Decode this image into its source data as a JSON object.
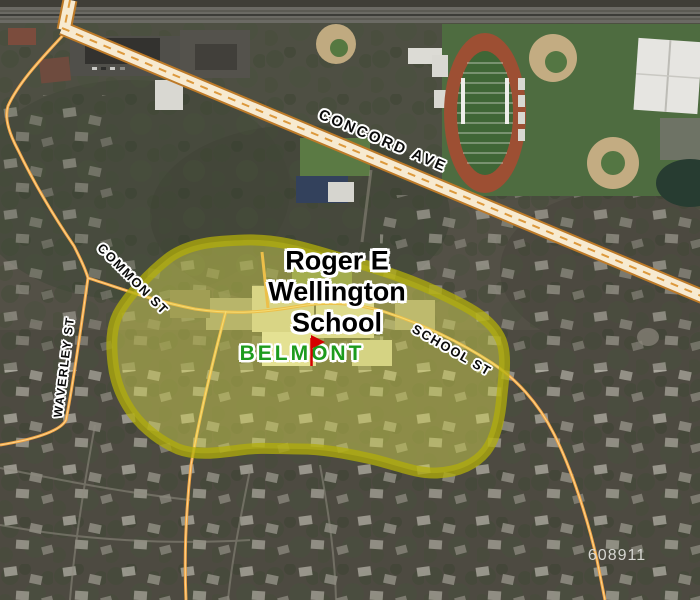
{
  "map": {
    "streets": {
      "concord": "CONCORD AVE",
      "common": "COMMON ST",
      "waverley": "WAVERLEY ST",
      "school": "SCHOOL ST"
    },
    "school_label": {
      "line1": "Roger E",
      "line2": "Wellington",
      "line3": "School"
    },
    "town_label": "BELMONT",
    "map_number": "608911",
    "zone": {
      "fill": "#e8e654",
      "fill_opacity": "0.42",
      "border": "#b2ad0a"
    },
    "marker": {
      "color": "#d40000"
    },
    "road_colors": {
      "major_fill": "#f7ead0",
      "major_casing": "#bd7a28",
      "major_dash": "#dd993c",
      "minor": "#f0a243",
      "minor_core": "#ffd891"
    },
    "label_colors": {
      "street": "#0a0a0a",
      "school": "#000000",
      "town": "#1d9b1d",
      "map_number": "#d6d6d2"
    }
  }
}
